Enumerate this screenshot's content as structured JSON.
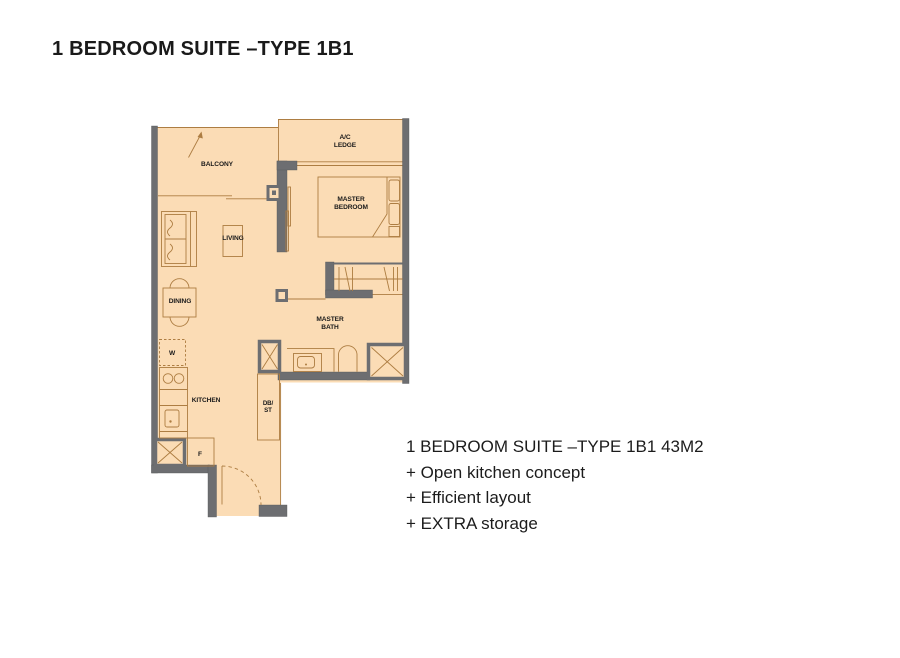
{
  "title": "1 BEDROOM SUITE –TYPE 1B1",
  "floor_plan": {
    "colors": {
      "floor": "#fbdcb5",
      "wall": "#6d6e71",
      "furniture_line": "#ad7d42",
      "label_text": "#1a1a1a"
    },
    "rooms": {
      "balcony": "BALCONY",
      "ac_ledge_line1": "A/C",
      "ac_ledge_line2": "LEDGE",
      "master_bedroom_line1": "MASTER",
      "master_bedroom_line2": "BEDROOM",
      "living": "LIVING",
      "dining": "DINING",
      "kitchen": "KITCHEN",
      "master_bath_line1": "MASTER",
      "master_bath_line2": "BATH",
      "washer": "W",
      "fridge": "F",
      "db_st_line1": "DB/",
      "db_st_line2": "ST"
    }
  },
  "description": {
    "lines": [
      "1 BEDROOM SUITE –TYPE 1B1 43M2",
      "+ Open kitchen concept",
      "+ Efficient layout",
      "+ EXTRA storage"
    ]
  }
}
